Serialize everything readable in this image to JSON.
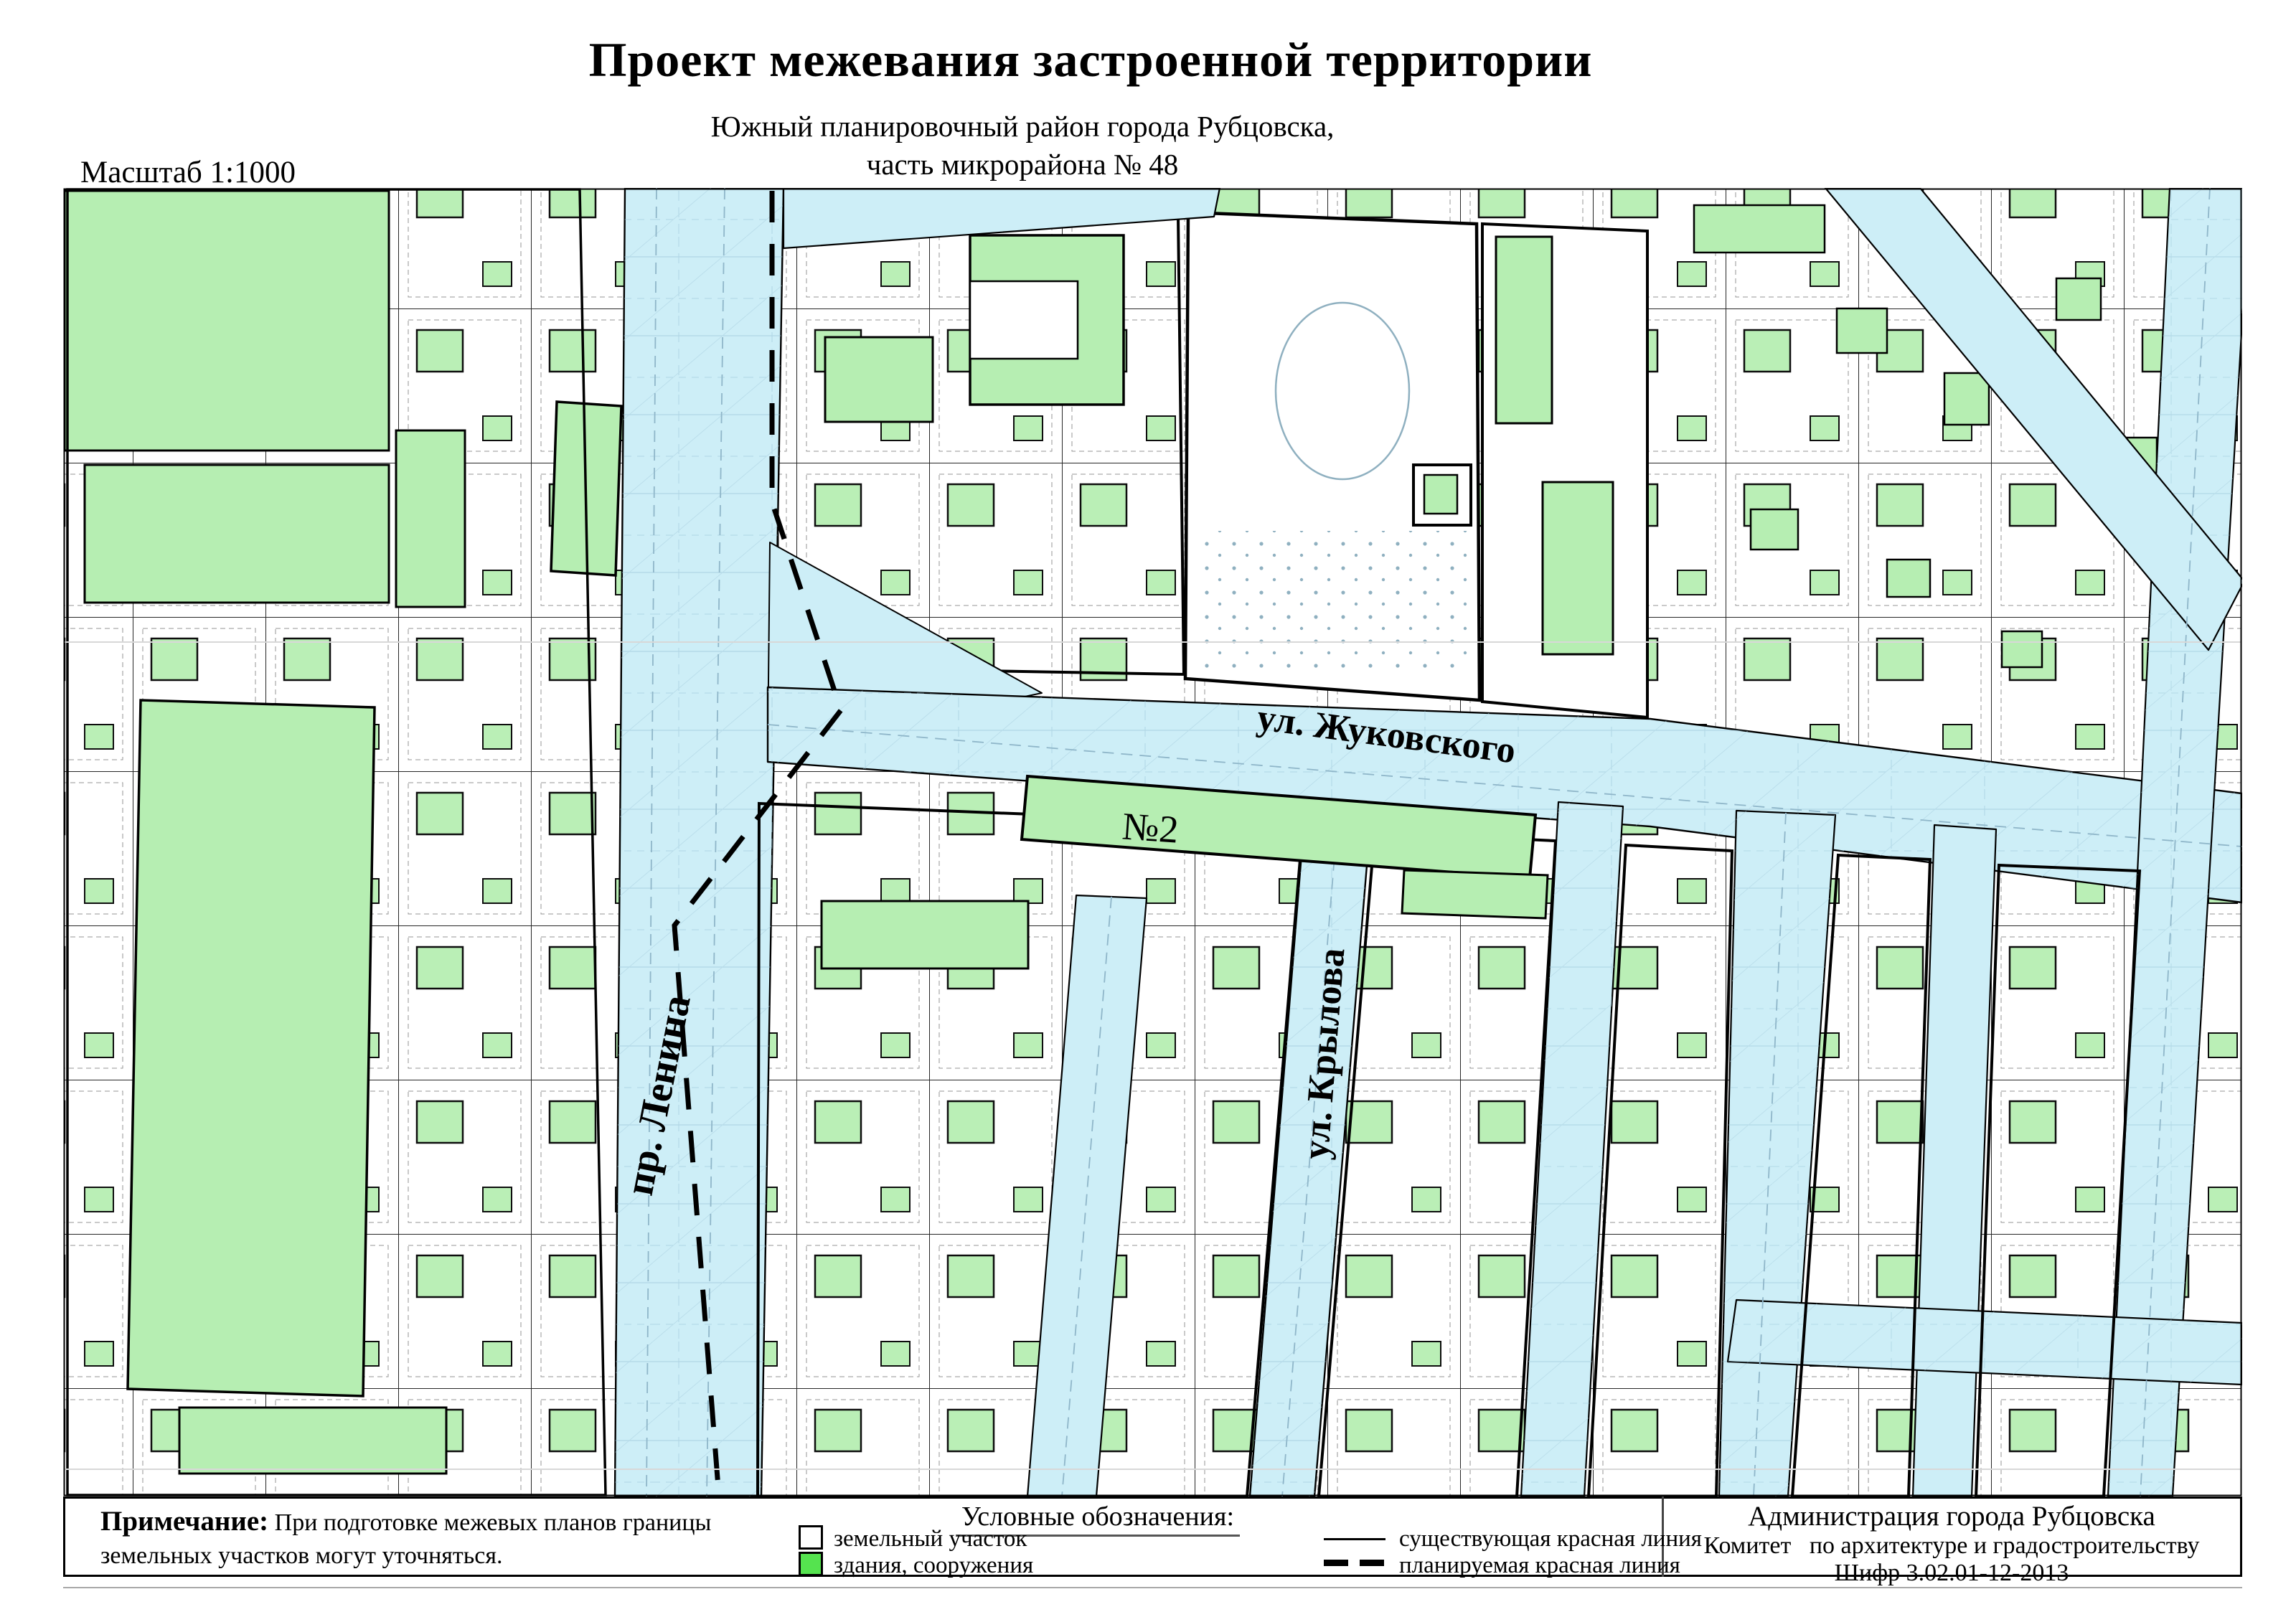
{
  "header": {
    "title": "Проект межевания застроенной территории",
    "subtitle_line1": "Южный планировочный район города Рубцовска,",
    "subtitle_line2": "часть микрорайона № 48",
    "scale_label": "Масштаб 1:1000"
  },
  "map": {
    "labels": {
      "street_lenina": "пр. Ленина",
      "street_zhukovskogo": "ул. Жуковского",
      "street_krylova": "ул. Крылова",
      "building_no2": "№2"
    },
    "colors": {
      "street_fill": "#cdeef7",
      "building_fill": "#b6eeb2",
      "linework": "#8fb6c9",
      "boundary": "#000000"
    }
  },
  "footer": {
    "note": {
      "label": "Примечание:",
      "text_line1": "При подготовке межевых планов границы",
      "text_line2": "земельных участков могут уточняться."
    },
    "legend": {
      "title": "Условные обозначения:",
      "items": [
        {
          "label": "земельный участок"
        },
        {
          "label": "здания, сооружения"
        },
        {
          "label": "существующая красная линия"
        },
        {
          "label": "планируемая красная линия"
        }
      ],
      "building_swatch_color": "#55e34f"
    },
    "org": {
      "line1": "Администрация города Рубцовска",
      "line2": "Комитет   по архитектуре и градостроительству",
      "line3": "Шифр 3.02.01-12-2013"
    }
  }
}
